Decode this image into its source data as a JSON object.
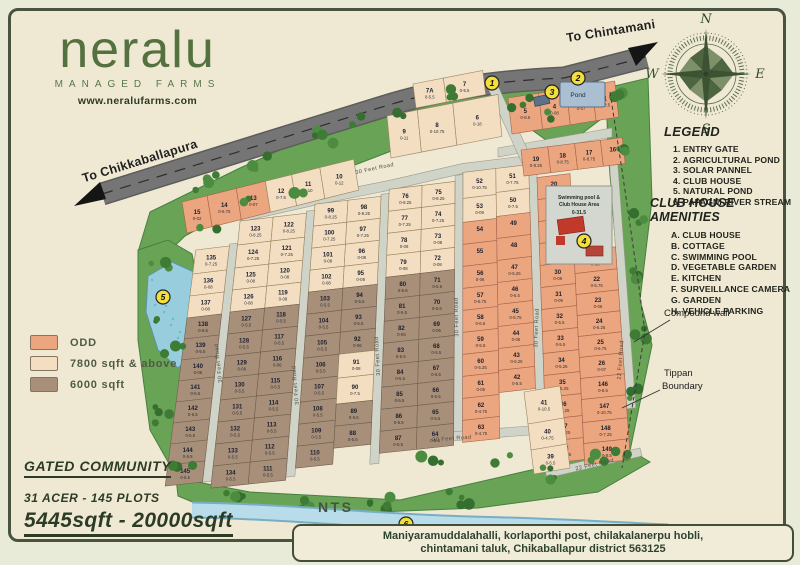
{
  "logo": {
    "name": "neralu",
    "tagline": "MANAGED FARMS",
    "website": "www.neralufarms.com"
  },
  "roads": {
    "to_right": "To Chintamani",
    "to_left": "To Chikkaballapura",
    "internal": "30 Feet Road",
    "edge": "22 Feet Road"
  },
  "compass": {
    "n": "N",
    "e": "E",
    "s": "S",
    "w": "W"
  },
  "legend": {
    "title": "LEGEND",
    "items": [
      "1. ENTRY GATE",
      "2. AGRICULTURAL POND",
      "3. SOLAR PANNEL",
      "4. CLUB HOUSE",
      "5. NATURAL POND",
      "6. PAPAGNI RIVER STREAM"
    ]
  },
  "amenities": {
    "title": "CLUB HOUSE AMENITIES",
    "items": [
      "A. CLUB HOUSE",
      "B. COTTAGE",
      "C. SWIMMING POOL",
      "D. VEGETABLE GARDEN",
      "E. KITCHEN",
      "F. SURVEILLANCE CAMERA",
      "G. GARDEN",
      "H. VEHICLE PARKING"
    ]
  },
  "color_key": [
    {
      "label": "ODD",
      "color": "#eba57f"
    },
    {
      "label": "7800 sqft & above",
      "color": "#f3dec2"
    },
    {
      "label": "6000 sqft",
      "color": "#a78f7a"
    }
  ],
  "community": {
    "title": "GATED COMMUNITY",
    "line1": "31 ACER - 145 PLOTS",
    "line2": "5445sqft - 20000sqft"
  },
  "address": {
    "line1": "Maniyaramuddalahalli, korlaporthi post, chilakalanerpu hobli,",
    "line2": "chintamani taluk, Chikaballapur district 563125"
  },
  "labels": {
    "pond": "Pond",
    "nts": "NTS",
    "compound_wall": "Compound wall",
    "tippan_line1": "Tippan",
    "tippan_line2": "Boundary"
  },
  "clubhouse": {
    "line1": "Swimming pool &",
    "line2": "Club House Area",
    "area": "0-31.5"
  },
  "markers": [
    "1",
    "2",
    "3",
    "4",
    "5",
    "6"
  ],
  "map": {
    "columns": {
      "A": [
        {
          "no": "135",
          "area": "0-7.25",
          "zone": "cream"
        },
        {
          "no": "136",
          "area": "0-08",
          "zone": "cream"
        },
        {
          "no": "137",
          "area": "0-08",
          "zone": "cream"
        },
        {
          "no": "138",
          "area": "0-5.5",
          "zone": "brown"
        },
        {
          "no": "139",
          "area": "0-5.5",
          "zone": "brown"
        },
        {
          "no": "140",
          "area": "0-06",
          "zone": "brown"
        },
        {
          "no": "141",
          "area": "0-5.5",
          "zone": "brown"
        },
        {
          "no": "142",
          "area": "0-5.5",
          "zone": "brown"
        },
        {
          "no": "143",
          "area": "0-5.5",
          "zone": "brown"
        },
        {
          "no": "144",
          "area": "0-5.5",
          "zone": "brown"
        },
        {
          "no": "145",
          "area": "0-5.5",
          "zone": "brown"
        }
      ],
      "BL": [
        {
          "no": "123",
          "area": "0-8.25",
          "zone": "cream"
        },
        {
          "no": "124",
          "area": "0-7.25",
          "zone": "cream"
        },
        {
          "no": "125",
          "area": "0-08",
          "zone": "cream"
        },
        {
          "no": "126",
          "area": "0-08",
          "zone": "cream"
        },
        {
          "no": "127",
          "area": "0-5.5",
          "zone": "brown"
        },
        {
          "no": "128",
          "area": "0-5.5",
          "zone": "brown"
        },
        {
          "no": "129",
          "area": "0-06",
          "zone": "brown"
        },
        {
          "no": "130",
          "area": "0-5.5",
          "zone": "brown"
        },
        {
          "no": "131",
          "area": "0-5.5",
          "zone": "brown"
        },
        {
          "no": "132",
          "area": "0-5.5",
          "zone": "brown"
        },
        {
          "no": "133",
          "area": "0-5.5",
          "zone": "brown"
        },
        {
          "no": "134",
          "area": "0-5.5",
          "zone": "brown"
        }
      ],
      "BR": [
        {
          "no": "122",
          "area": "0-8.25",
          "zone": "cream"
        },
        {
          "no": "121",
          "area": "0-7.25",
          "zone": "cream"
        },
        {
          "no": "120",
          "area": "0-08",
          "zone": "cream"
        },
        {
          "no": "119",
          "area": "0-08",
          "zone": "cream"
        },
        {
          "no": "118",
          "area": "0-5.5",
          "zone": "brown"
        },
        {
          "no": "117",
          "area": "0-5.5",
          "zone": "brown"
        },
        {
          "no": "116",
          "area": "0-06",
          "zone": "brown"
        },
        {
          "no": "115",
          "area": "0-5.5",
          "zone": "brown"
        },
        {
          "no": "114",
          "area": "0-5.5",
          "zone": "brown"
        },
        {
          "no": "113",
          "area": "0-5.5",
          "zone": "brown"
        },
        {
          "no": "112",
          "area": "0-5.5",
          "zone": "brown"
        },
        {
          "no": "111",
          "area": "0-5.5",
          "zone": "brown"
        }
      ],
      "CL": [
        {
          "no": "99",
          "area": "0-8.25",
          "zone": "cream"
        },
        {
          "no": "100",
          "area": "0-7.25",
          "zone": "cream"
        },
        {
          "no": "101",
          "area": "0-08",
          "zone": "cream"
        },
        {
          "no": "102",
          "area": "0-08",
          "zone": "cream"
        },
        {
          "no": "103",
          "area": "0-5.5",
          "zone": "brown"
        },
        {
          "no": "104",
          "area": "0-5.5",
          "zone": "brown"
        },
        {
          "no": "105",
          "area": "0-5.5",
          "zone": "brown"
        },
        {
          "no": "106",
          "area": "0-5.5",
          "zone": "brown"
        },
        {
          "no": "107",
          "area": "0-5.5",
          "zone": "brown"
        },
        {
          "no": "108",
          "area": "0-5.5",
          "zone": "brown"
        },
        {
          "no": "109",
          "area": "0-5.5",
          "zone": "brown"
        },
        {
          "no": "110",
          "area": "0-5.5",
          "zone": "brown"
        }
      ],
      "CR": [
        {
          "no": "98",
          "area": "0-8.25",
          "zone": "cream"
        },
        {
          "no": "97",
          "area": "0-7.25",
          "zone": "cream"
        },
        {
          "no": "96",
          "area": "0-08",
          "zone": "cream"
        },
        {
          "no": "95",
          "area": "0-08",
          "zone": "cream"
        },
        {
          "no": "94",
          "area": "0-5.5",
          "zone": "brown"
        },
        {
          "no": "93",
          "area": "0-5.5",
          "zone": "brown"
        },
        {
          "no": "92",
          "area": "0-06",
          "zone": "brown"
        },
        {
          "no": "91",
          "area": "0-08",
          "zone": "cream"
        },
        {
          "no": "90",
          "area": "0-7.5",
          "zone": "cream"
        },
        {
          "no": "89",
          "area": "0-5.5",
          "zone": "brown"
        },
        {
          "no": "88",
          "area": "0-5.5",
          "zone": "brown"
        }
      ],
      "DL": [
        {
          "no": "76",
          "area": "0-8.25",
          "zone": "cream"
        },
        {
          "no": "77",
          "area": "0-7.25",
          "zone": "cream"
        },
        {
          "no": "78",
          "area": "0-08",
          "zone": "cream"
        },
        {
          "no": "79",
          "area": "0-08",
          "zone": "cream"
        },
        {
          "no": "80",
          "area": "0-5.5",
          "zone": "brown"
        },
        {
          "no": "81",
          "area": "0-5.5",
          "zone": "brown"
        },
        {
          "no": "82",
          "area": "0-06",
          "zone": "brown"
        },
        {
          "no": "83",
          "area": "0-5.5",
          "zone": "brown"
        },
        {
          "no": "84",
          "area": "0-5.5",
          "zone": "brown"
        },
        {
          "no": "85",
          "area": "0-5.5",
          "zone": "brown"
        },
        {
          "no": "86",
          "area": "0-5.5",
          "zone": "brown"
        },
        {
          "no": "87",
          "area": "0-5.5",
          "zone": "brown"
        }
      ],
      "DR": [
        {
          "no": "75",
          "area": "0-8.25",
          "zone": "cream"
        },
        {
          "no": "74",
          "area": "0-7.25",
          "zone": "cream"
        },
        {
          "no": "73",
          "area": "0-08",
          "zone": "cream"
        },
        {
          "no": "72",
          "area": "0-08",
          "zone": "cream"
        },
        {
          "no": "71",
          "area": "0-5.5",
          "zone": "brown"
        },
        {
          "no": "70",
          "area": "0-5.5",
          "zone": "brown"
        },
        {
          "no": "69",
          "area": "0-06",
          "zone": "brown"
        },
        {
          "no": "68",
          "area": "0-5.5",
          "zone": "brown"
        },
        {
          "no": "67",
          "area": "0-5.5",
          "zone": "brown"
        },
        {
          "no": "66",
          "area": "0-5.5",
          "zone": "brown"
        },
        {
          "no": "65",
          "area": "0-5.5",
          "zone": "brown"
        },
        {
          "no": "64",
          "area": "0-5.5",
          "zone": "brown"
        }
      ],
      "EL": [
        {
          "no": "52",
          "area": "0-10.75",
          "zone": "cream"
        },
        {
          "no": "53",
          "area": "0-09",
          "zone": "cream"
        },
        {
          "no": "54",
          "area": "",
          "zone": "odd"
        },
        {
          "no": "55",
          "area": "",
          "zone": "odd"
        },
        {
          "no": "56",
          "area": "0-06",
          "zone": "odd"
        },
        {
          "no": "57",
          "area": "0-5.75",
          "zone": "odd"
        },
        {
          "no": "58",
          "area": "0-6.5",
          "zone": "odd"
        },
        {
          "no": "59",
          "area": "0-5.5",
          "zone": "odd"
        },
        {
          "no": "60",
          "area": "0-5.25",
          "zone": "odd"
        },
        {
          "no": "61",
          "area": "0-05",
          "zone": "odd"
        },
        {
          "no": "62",
          "area": "0-4.75",
          "zone": "odd"
        },
        {
          "no": "63",
          "area": "0-4.75",
          "zone": "odd"
        }
      ],
      "ER": [
        {
          "no": "51",
          "area": "0-7.75",
          "zone": "cream"
        },
        {
          "no": "50",
          "area": "0-7.5",
          "zone": "cream"
        },
        {
          "no": "49",
          "area": "",
          "zone": "odd"
        },
        {
          "no": "48",
          "area": "",
          "zone": "odd"
        },
        {
          "no": "47",
          "area": "0-5.25",
          "zone": "odd"
        },
        {
          "no": "46",
          "area": "0-5.5",
          "zone": "odd"
        },
        {
          "no": "45",
          "area": "0-5.75",
          "zone": "odd"
        },
        {
          "no": "44",
          "area": "0-06",
          "zone": "odd"
        },
        {
          "no": "43",
          "area": "0-6.25",
          "zone": "odd"
        },
        {
          "no": "42",
          "area": "0-5.5",
          "zone": "odd"
        }
      ],
      "E2": [
        {
          "no": "41",
          "area": "0-10.5",
          "zone": "cream"
        },
        {
          "no": "40",
          "area": "0-4.75",
          "zone": "cream"
        },
        {
          "no": "39",
          "area": "0-5.5",
          "zone": "cream"
        }
      ],
      "FL": [
        {
          "no": "20",
          "area": "0-7.5",
          "zone": "odd"
        },
        {
          "no": "27",
          "area": "",
          "zone": "odd"
        },
        {
          "no": "28",
          "area": "",
          "zone": "odd"
        },
        {
          "no": "29",
          "area": "0-6.75",
          "zone": "odd"
        },
        {
          "no": "30",
          "area": "0-08",
          "zone": "odd"
        },
        {
          "no": "31",
          "area": "0-09",
          "zone": "odd"
        },
        {
          "no": "32",
          "area": "0-5.5",
          "zone": "odd"
        },
        {
          "no": "33",
          "area": "0-5.5",
          "zone": "odd"
        },
        {
          "no": "34",
          "area": "0-5.25",
          "zone": "odd"
        },
        {
          "no": "35",
          "area": "0-5.25",
          "zone": "odd"
        },
        {
          "no": "36",
          "area": "0-5.25",
          "zone": "odd"
        },
        {
          "no": "37",
          "area": "0-5.25",
          "zone": "odd"
        },
        {
          "no": "38",
          "area": "0-5.75",
          "zone": "odd"
        }
      ],
      "FR": [
        {
          "no": "21",
          "area": "0-09",
          "zone": "odd"
        },
        {
          "no": "22",
          "area": "0-5.75",
          "zone": "odd"
        },
        {
          "no": "23",
          "area": "0-06",
          "zone": "odd"
        },
        {
          "no": "24",
          "area": "0-6.25",
          "zone": "odd"
        },
        {
          "no": "25",
          "area": "0-6.75",
          "zone": "odd"
        },
        {
          "no": "26",
          "area": "0-07",
          "zone": "odd"
        },
        {
          "no": "146",
          "area": "0-8.5",
          "zone": "odd"
        },
        {
          "no": "147",
          "area": "0-10.75",
          "zone": "odd"
        },
        {
          "no": "148",
          "area": "0-7.25",
          "zone": "odd"
        },
        {
          "no": "149",
          "area": "0-8.5",
          "zone": "odd"
        }
      ]
    },
    "top_rows": {
      "R0": [
        {
          "no": "7A",
          "area": "0-5.5",
          "zone": "cream"
        },
        {
          "no": "7",
          "area": "0-5.5",
          "zone": "cream"
        }
      ],
      "R1": [
        {
          "no": "9",
          "area": "0-11",
          "zone": "cream"
        },
        {
          "no": "8",
          "area": "0-10.75",
          "zone": "cream"
        },
        {
          "no": "6",
          "area": "0-18",
          "zone": "cream"
        }
      ],
      "R2": [
        {
          "no": "15",
          "area": "0-02",
          "zone": "odd"
        },
        {
          "no": "14",
          "area": "0-6.75",
          "zone": "odd"
        },
        {
          "no": "13",
          "area": "0-07",
          "zone": "odd"
        },
        {
          "no": "12",
          "area": "0-7.5",
          "zone": "cream"
        },
        {
          "no": "11",
          "area": "0-10",
          "zone": "cream"
        },
        {
          "no": "10",
          "area": "0-12",
          "zone": "cream"
        }
      ],
      "R3": [
        {
          "no": "5",
          "area": "0-8.5",
          "zone": "odd"
        },
        {
          "no": "4",
          "area": "0-08",
          "zone": "odd"
        },
        {
          "no": "3",
          "area": "0-07",
          "zone": "odd"
        },
        {
          "no": "1",
          "area": "0-2.5",
          "zone": "odd"
        }
      ],
      "R4": [
        {
          "no": "19",
          "area": "0-8.25",
          "zone": "odd"
        },
        {
          "no": "18",
          "area": "0-8.75",
          "zone": "odd"
        },
        {
          "no": "17",
          "area": "0-8.75",
          "zone": "odd"
        },
        {
          "no": "16",
          "area": "",
          "zone": "odd"
        }
      ]
    }
  }
}
